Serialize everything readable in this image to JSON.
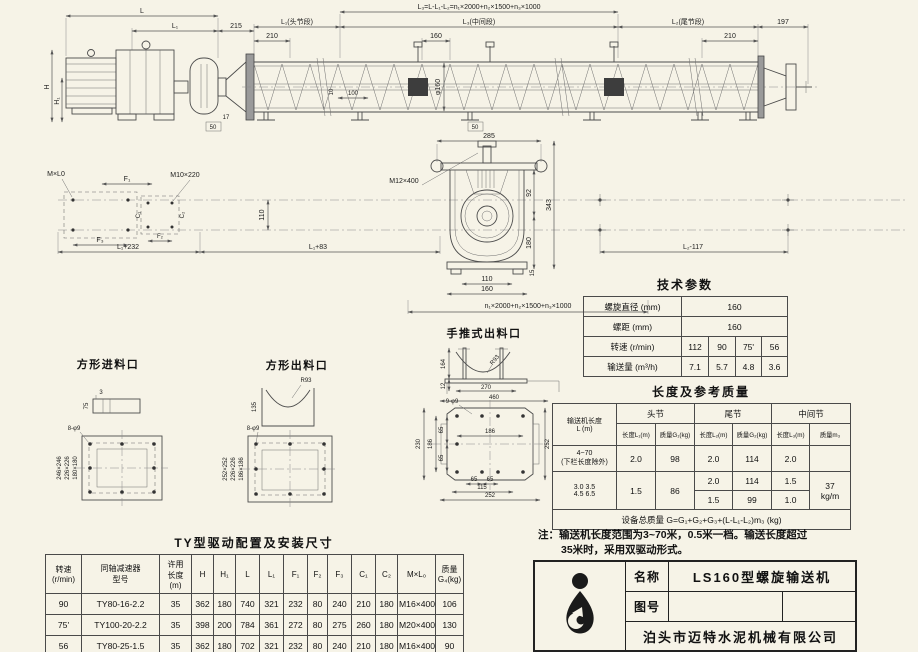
{
  "doc": {
    "note_line1": "注：输送机长度范围为3~70米，0.5米一档。输送长度超过",
    "note_line2": "35米时，采用双驱动形式。"
  },
  "title_block": {
    "name_label": "名称",
    "name_value": "LS160型螺旋输送机",
    "no_label": "图号",
    "company": "泊头市迈特水泥机械有限公司"
  },
  "tech_table": {
    "title": "技术参数",
    "row1_label": "螺旋直径 (mm)",
    "row1_value": "160",
    "row2_label": "螺距 (mm)",
    "row2_value": "160",
    "row3_label": "转速 (r/min)",
    "row3_values": [
      "112",
      "90",
      "75'",
      "56"
    ],
    "row4_label": "输送量 (m³/h)",
    "row4_values": [
      "7.1",
      "5.7",
      "4.8",
      "3.6"
    ]
  },
  "length_table": {
    "title": "长度及参考质量",
    "col_length": "输送机长度\nL (m)",
    "g_head": "头节",
    "g_tail": "尾节",
    "g_mid": "中间节",
    "h_l1": "长度L₁(m)",
    "h_g1": "质量G₁(kg)",
    "h_l2": "长度L₂(m)",
    "h_g2": "质量G₂(kg)",
    "h_l3": "长度L₃(m)",
    "h_m3": "质量m₃",
    "r1_len": "4~70\n(下栏长度除外)",
    "r1": [
      "2.0",
      "98",
      "2.0",
      "114",
      "2.0"
    ],
    "r2_len": "3.0  3.5\n4.5  6.5",
    "r2a": [
      "1.5",
      "86",
      "2.0",
      "114",
      "1.5"
    ],
    "r2b": [
      "1.5",
      "99",
      "1.0"
    ],
    "m3_value": "37\nkg/m",
    "footer": "设备总质量   G=G₁+G₂+G₃+(L-L₁-L₂)m₃    (kg)"
  },
  "ty_table": {
    "title": "TY型驱动配置及安装尺寸",
    "headers": [
      "转速\n(r/min)",
      "同轴减速器\n型号",
      "许用\n长度\n(m)",
      "H",
      "H₁",
      "L",
      "L₁",
      "F₁",
      "F₂",
      "F₃",
      "C₁",
      "C₂",
      "M×L₀",
      "质量\nG₄(kg)"
    ],
    "rows": [
      [
        "90",
        "TY80-16-2.2",
        "35",
        "362",
        "180",
        "740",
        "321",
        "232",
        "80",
        "240",
        "210",
        "180",
        "M16×400",
        "106"
      ],
      [
        "75'",
        "TY100-20-2.2",
        "35",
        "398",
        "200",
        "784",
        "361",
        "272",
        "80",
        "275",
        "260",
        "180",
        "M20×400",
        "130"
      ],
      [
        "56",
        "TY80-25-1.5",
        "35",
        "362",
        "180",
        "702",
        "321",
        "232",
        "80",
        "240",
        "210",
        "180",
        "M16×400",
        "90"
      ]
    ]
  },
  "top": {
    "L": "L",
    "L1": "L₁",
    "d215": "215",
    "formula": "L₃=L-L₁-L₂=n₁×2000+n₂×1500+n₃×1000",
    "L1_head": "L₁(头节段)",
    "L3_mid": "L₃(中间段)",
    "L2_tail": "L₂(尾节段)",
    "d210a": "210",
    "d160": "160",
    "d210b": "210",
    "d197": "197",
    "H": "H",
    "H1": "H₁",
    "phi": "φ160",
    "d100": "100",
    "d10": "10",
    "d17": "17",
    "d50a": "50",
    "d50b": "50"
  },
  "plan": {
    "MxL0": "M×L0",
    "F1": "F₁",
    "F2": "F₂",
    "F3": "F₃",
    "C1": "C₁",
    "C2": "C₂",
    "M10": "M10×220",
    "M12": "M12×400",
    "d110": "110",
    "L1p232": "L₁+232",
    "L1p83": "L₁+83",
    "L2m117": "L₂-117"
  },
  "sec": {
    "d285": "285",
    "d343": "343",
    "d92": "92",
    "d180": "180",
    "d110": "110",
    "d160": "160",
    "d15": "15",
    "modules": "n₁×2000+n₂×1500+n₃×1000"
  },
  "hand": {
    "title": "手推式出料口",
    "d164": "164",
    "d12": "12",
    "d270": "270",
    "d460": "460",
    "r": "R93"
  },
  "sqin": {
    "title": "方形进料口",
    "d3": "3",
    "d75": "75",
    "holes": "8-φ9",
    "o": "246×246",
    "m": "226×226",
    "i": "180×180"
  },
  "sqout": {
    "title": "方形出料口",
    "r": "R93",
    "d135": "135",
    "holes": "8-φ9",
    "o": "252×252",
    "m": "226×226",
    "i": "186×186"
  },
  "flg": {
    "holes": "9-φ9",
    "d230": "230",
    "d186v": "186",
    "d65a": "65",
    "d65b": "65",
    "d186h": "186",
    "d252r": "252",
    "d65c": "65",
    "d65d": "65",
    "d115": "115",
    "d252b": "252"
  }
}
